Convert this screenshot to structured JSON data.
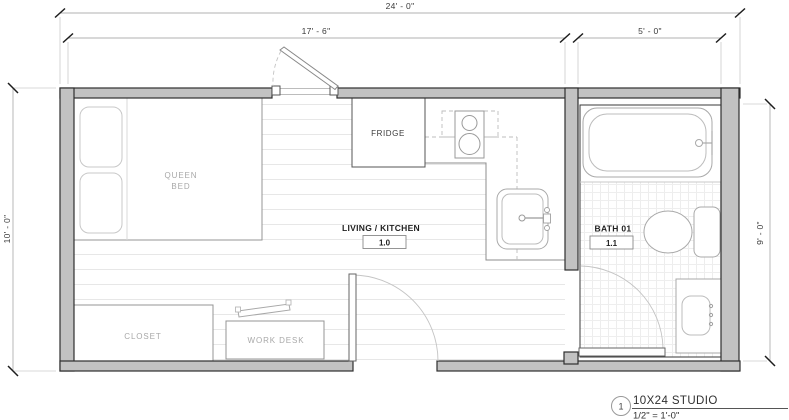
{
  "plan": {
    "dims": {
      "overall_w": "24' - 0\"",
      "living_w": "17' - 6\"",
      "bath_w": "5' - 0\"",
      "overall_h": "10' - 0\"",
      "bath_h": "9' - 0\""
    },
    "rooms": {
      "living": {
        "label": "LIVING / KITCHEN",
        "tag": "1.0"
      },
      "bath": {
        "label": "BATH 01",
        "tag": "1.1"
      }
    },
    "furniture": {
      "bed_line1": "QUEEN",
      "bed_line2": "BED",
      "closet": "CLOSET",
      "desk": "WORK DESK",
      "fridge": "FRIDGE"
    },
    "title_block": {
      "number": "1",
      "title": "10X24 STUDIO",
      "scale": "1/2\" = 1'-0\""
    },
    "colors": {
      "wall_fill": "#c2c2c2",
      "wall_edge": "#2e2e2e",
      "fixture_stroke": "#a9a9a9",
      "label_gray": "#a8a8a8",
      "text_dark": "#333333"
    }
  }
}
